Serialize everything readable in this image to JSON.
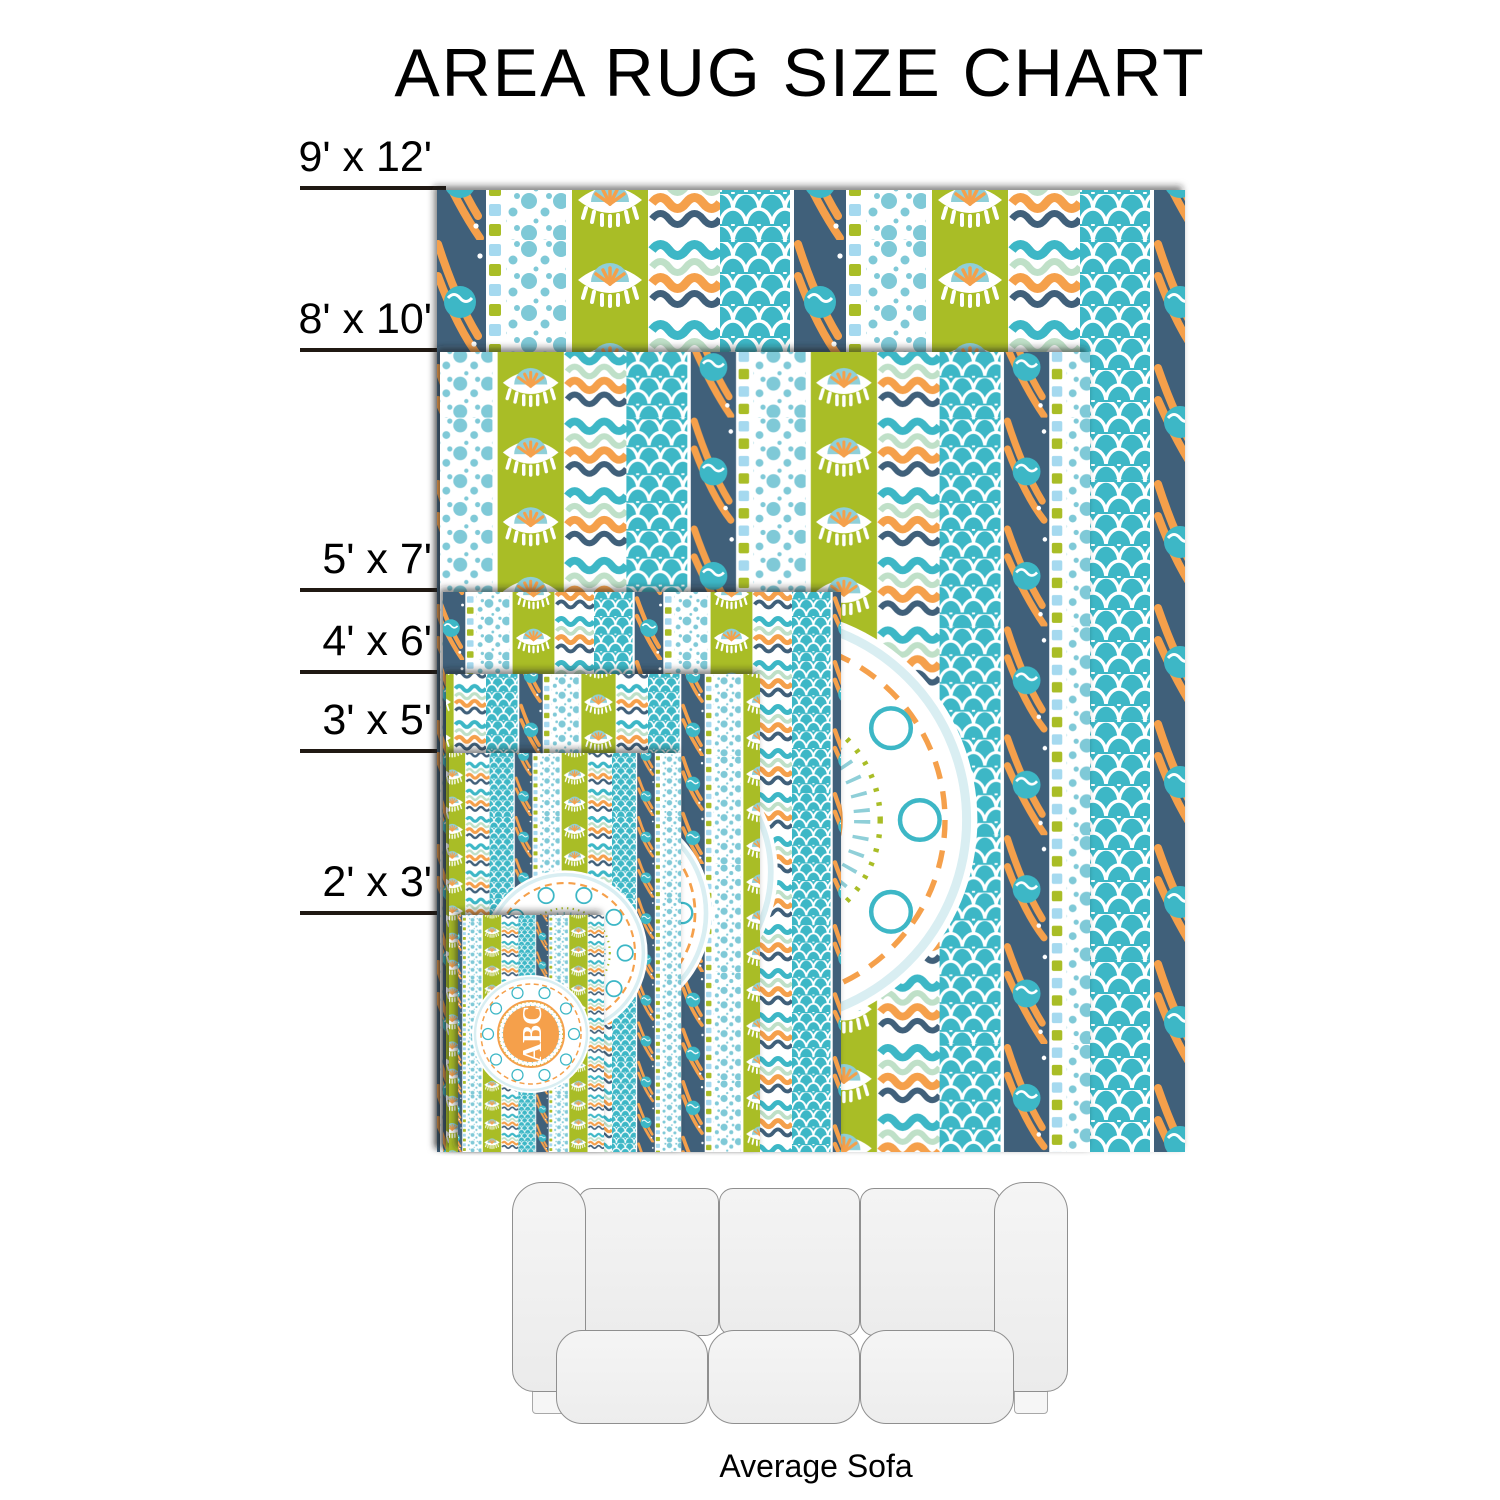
{
  "title": "AREA RUG SIZE CHART",
  "rug_sizes": [
    {
      "label": "9' x 12'",
      "width_ft": 9,
      "length_ft": 12
    },
    {
      "label": "8' x 10'",
      "width_ft": 8,
      "length_ft": 10
    },
    {
      "label": "5' x 7'",
      "width_ft": 5,
      "length_ft": 7
    },
    {
      "label": "4' x 6'",
      "width_ft": 4,
      "length_ft": 6
    },
    {
      "label": "3' x 5'",
      "width_ft": 3,
      "length_ft": 5
    },
    {
      "label": "2' x 3'",
      "width_ft": 2,
      "length_ft": 3
    }
  ],
  "monogram": "ABC",
  "sofa": {
    "label": "Average Sofa"
  },
  "palette": {
    "teal": "#3CB7C6",
    "light_teal": "#8FCFD8",
    "chartreuse_green": "#A9BD27",
    "orange": "#F5A04C",
    "navy": "#41607A",
    "light_blue": "#A5D9EF",
    "mint": "#BFE0C8",
    "label_line": "#201913",
    "sofa_fill": "#f2f2f2",
    "sofa_border": "#8f8f8f"
  },
  "chart_data": {
    "type": "table",
    "title": "AREA RUG SIZE CHART",
    "categories": [
      "9' x 12'",
      "8' x 10'",
      "5' x 7'",
      "4' x 6'",
      "3' x 5'",
      "2' x 3'"
    ],
    "sizes_ft": [
      [
        9,
        12
      ],
      [
        8,
        10
      ],
      [
        5,
        7
      ],
      [
        4,
        6
      ],
      [
        3,
        5
      ],
      [
        2,
        3
      ]
    ],
    "reference_object": "Average Sofa"
  }
}
